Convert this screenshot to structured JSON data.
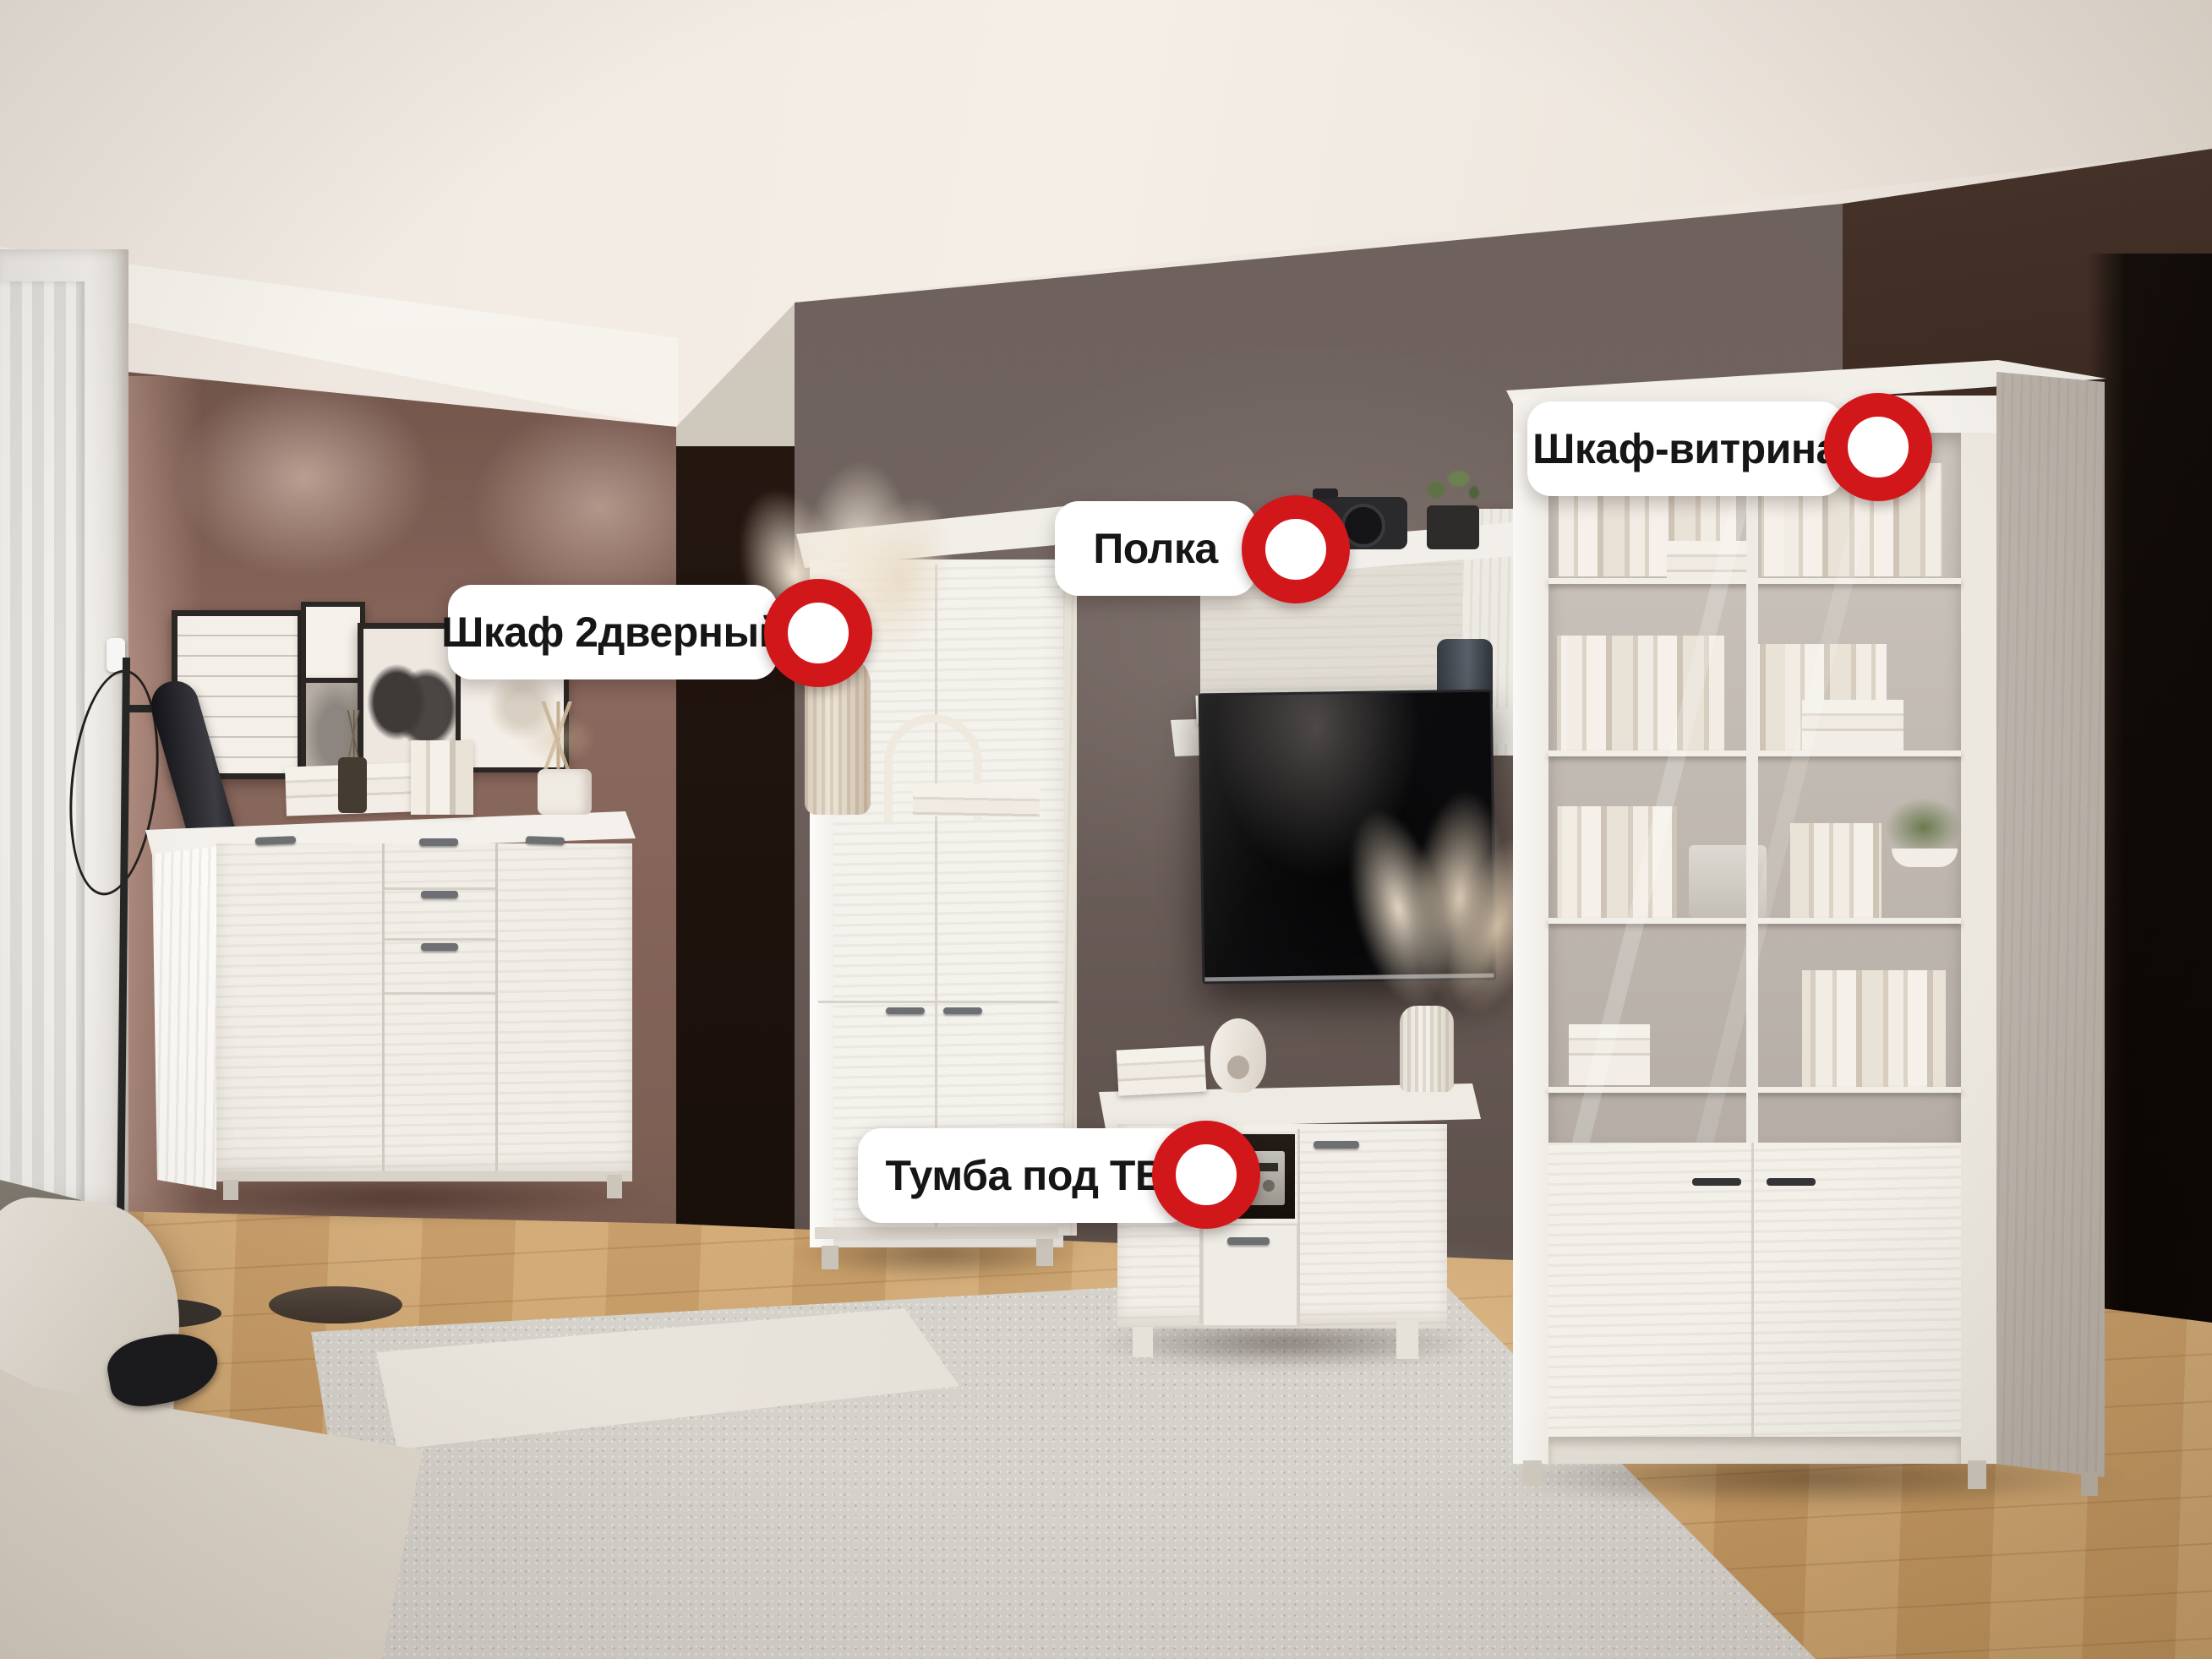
{
  "hotspots": [
    {
      "id": "wardrobe-2door",
      "label": "Шкаф 2дверный"
    },
    {
      "id": "shelf",
      "label": "Полка"
    },
    {
      "id": "display-cabinet",
      "label": "Шкаф-витрина"
    },
    {
      "id": "tv-stand",
      "label": "Тумба под ТВ"
    }
  ],
  "colors": {
    "accent_red": "#D2171B",
    "pill_background": "#FFFFFF",
    "label_text": "#161616",
    "wall_mauve": "#7A5A4F",
    "tv_wall_gray": "#6B5E59",
    "dark_wall": "#2E1F17",
    "floor_wood": "#D4AD7B",
    "furniture_white": "#F2EFEA"
  }
}
